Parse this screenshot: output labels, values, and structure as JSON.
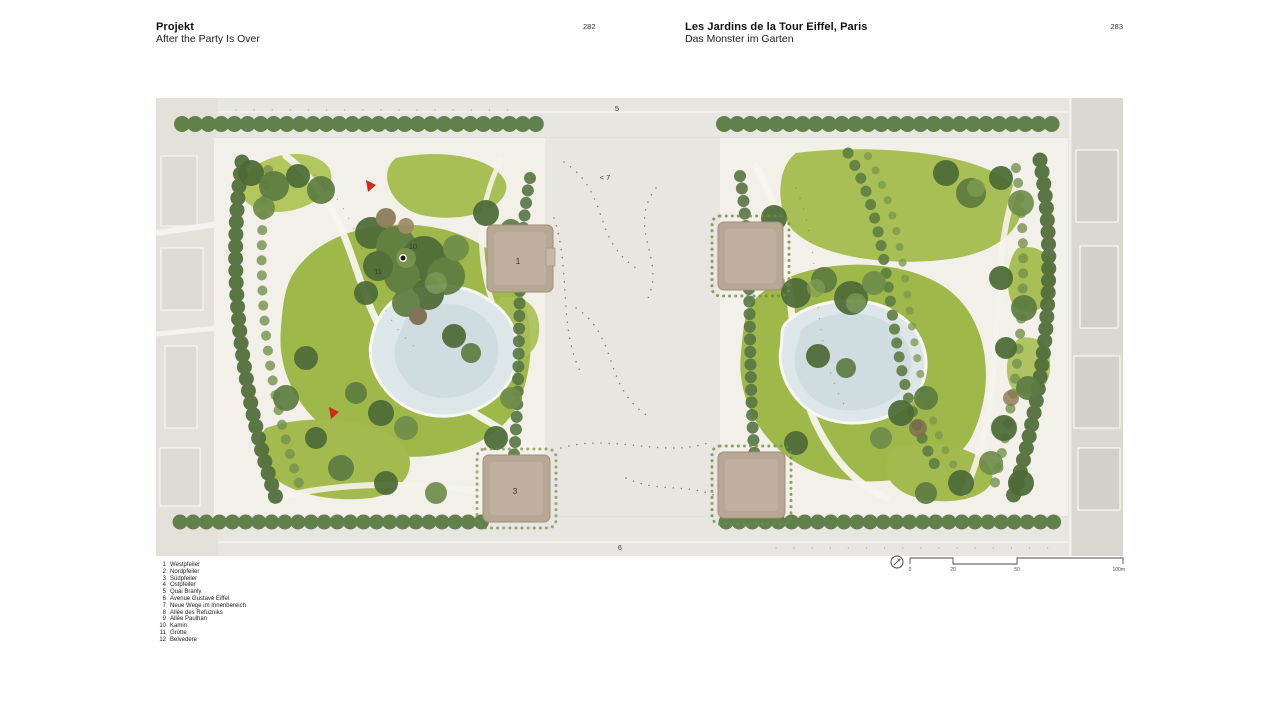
{
  "header": {
    "left": {
      "title": "Projekt",
      "subtitle": "After the Party Is Over",
      "page_number": "282"
    },
    "right": {
      "title": "Les Jardins de la Tour Eiffel, Paris",
      "subtitle": "Das Monster im Garten",
      "page_number": "283"
    }
  },
  "plan": {
    "labels": {
      "pier_west": "1",
      "pier_south": "3",
      "quai_branly": "5",
      "avenue_gustave_eiffel": "6",
      "neue_wege": "< 7",
      "kamin": "10",
      "grotte": "11"
    },
    "colors": {
      "lawn": "#a3bb4e",
      "tree_dark": "#4c6a36",
      "pond": "#dce5e7",
      "pier_brown": "#b7a795",
      "plaza": "#e9e6e1",
      "marker_red": "#d42a1c"
    }
  },
  "legend": {
    "items": [
      {
        "num": "1",
        "label": "Westpfeiler"
      },
      {
        "num": "2",
        "label": "Nordpfeiler"
      },
      {
        "num": "3",
        "label": "Südpfeiler"
      },
      {
        "num": "4",
        "label": "Ostpfeiler"
      },
      {
        "num": "5",
        "label": "Quai Branly"
      },
      {
        "num": "6",
        "label": "Avenue Gustave Eiffel"
      },
      {
        "num": "7",
        "label": "Neue Wege im Innenbereich"
      },
      {
        "num": "8",
        "label": "Allée des Refuzniks"
      },
      {
        "num": "9",
        "label": "Allée Paulhan"
      },
      {
        "num": "10",
        "label": "Kamin"
      },
      {
        "num": "11",
        "label": "Grotte"
      },
      {
        "num": "12",
        "label": "Belvedere"
      }
    ]
  },
  "scalebar": {
    "ticks": [
      "0",
      "20",
      "50",
      "100m"
    ]
  }
}
